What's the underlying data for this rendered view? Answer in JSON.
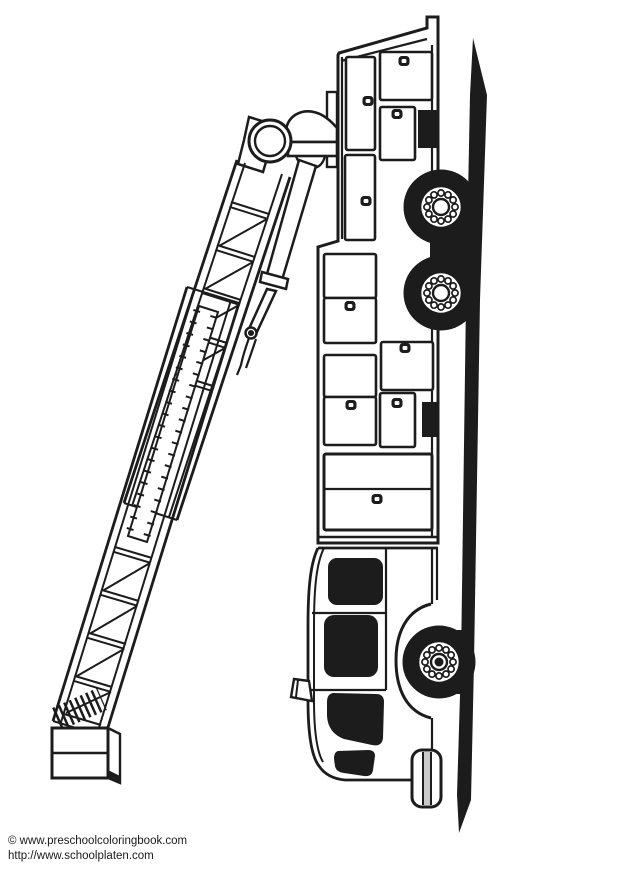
{
  "page": {
    "background": "#ffffff",
    "ink": "#1c1c1c",
    "width": 618,
    "height": 874
  },
  "caption": {
    "line1": "© www.preschoolcoloringbook.com",
    "line2": "http://www.schoolplaten.com"
  },
  "illustration": {
    "subject": "Fire truck with extended aerial ladder, side view rotated vertically; black and white coloring-page line art",
    "visible_parts": [
      "aerial ladder with lattice truss and telescoping section",
      "ladder pivot and pedestal",
      "hydraulic cylinder",
      "ladder foot box",
      "equipment compartments with handles",
      "two rear dual wheels",
      "front wheel with fender",
      "cab with three black windows",
      "side mirror",
      "front bumper",
      "ground line"
    ],
    "wheels_visible": 3,
    "ink_color": "#1c1c1c",
    "paper_color": "#ffffff"
  }
}
